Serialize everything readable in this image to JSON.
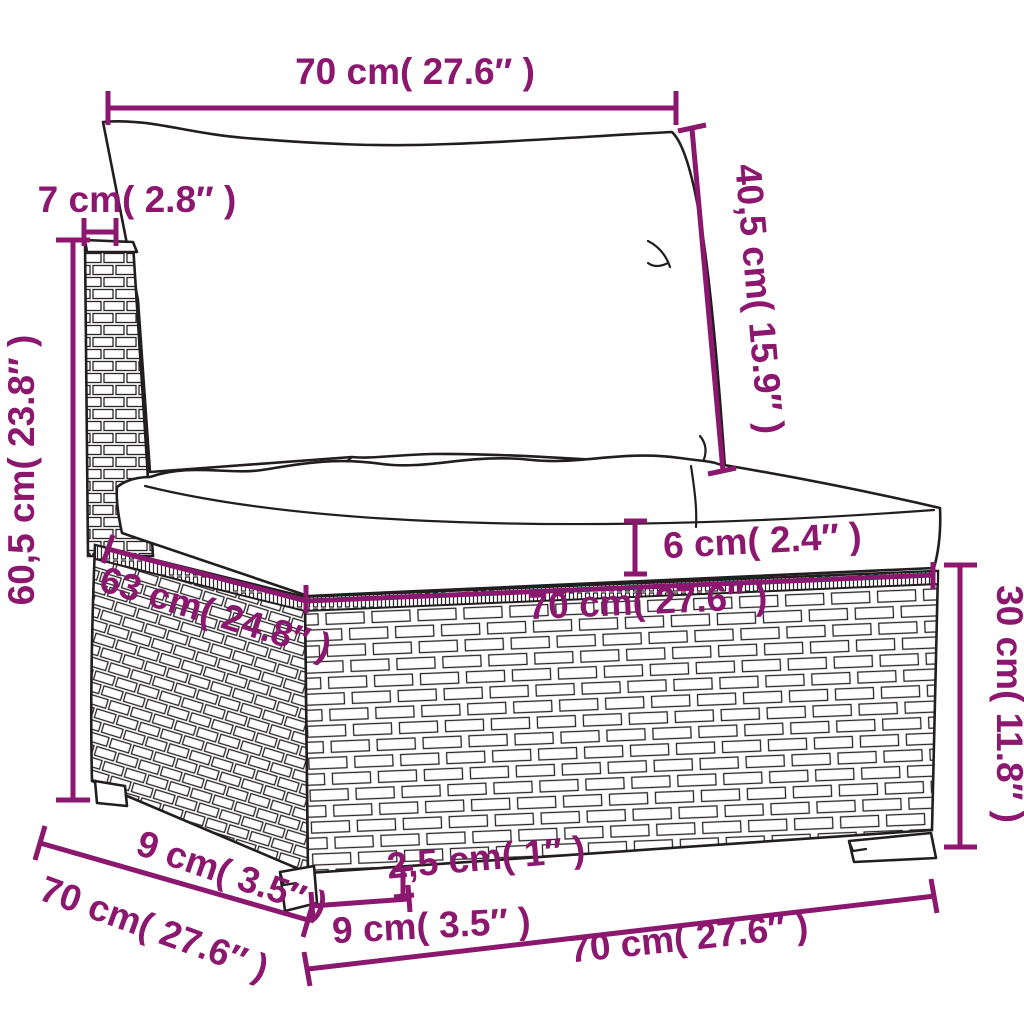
{
  "page": {
    "background": "#ffffff",
    "type": "product-dimension-diagram",
    "subject": "poly-rattan garden sofa middle section with back and seat cushions"
  },
  "style": {
    "dimension_color": "#8B176E",
    "line_art_color": "#221e1f"
  },
  "dimensions": {
    "back_cushion_width": "70 cm( 27.6″  )",
    "back_cushion_height": "40,5 cm( 15.9″  )",
    "back_frame_thickness": "7 cm( 2.8″  )",
    "total_height": "60,5 cm( 23.8″  )",
    "seat_depth": "63 cm( 24.8″  )",
    "seat_width": "70 cm( 27.6″  )",
    "seat_cushion_thickness": "6 cm( 2.4″  )",
    "base_height": "30 cm( 11.8″  )",
    "side_leg_depth": "9 cm( 3.5″  )",
    "total_depth": "70 cm( 27.6″  )",
    "leg_height": "2,5 cm( 1″  )",
    "front_leg_width": "9 cm( 3.5″  )",
    "total_width": "70 cm( 27.6″  )"
  }
}
